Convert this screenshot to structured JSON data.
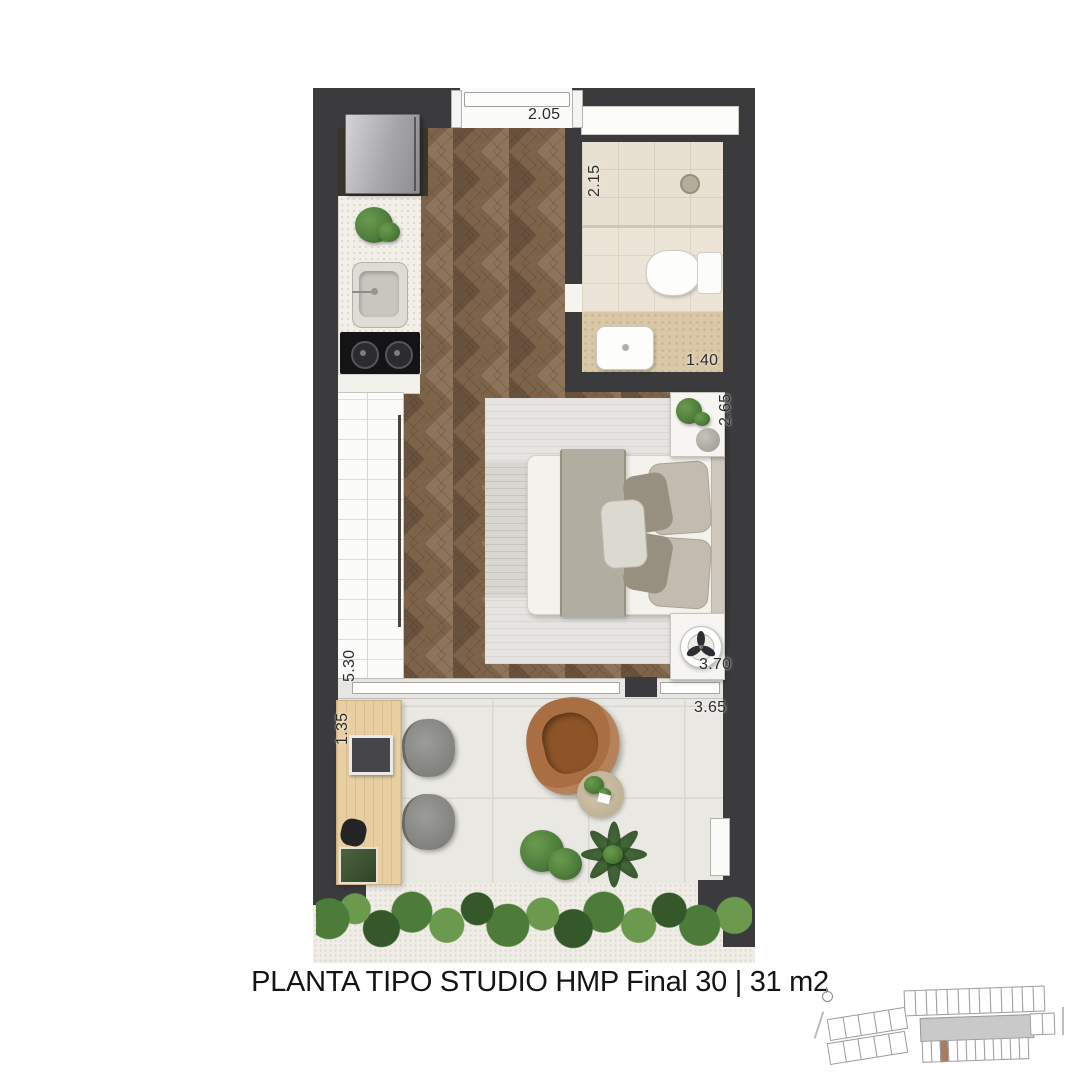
{
  "caption": "PLANTA TIPO STUDIO HMP Final 30 | 31 m2",
  "dims": {
    "entry": "2.05",
    "bath_width": "2.15",
    "bath_depth": "1.40",
    "bed_wall": "2.65",
    "wardrobe_wall": "5.30",
    "room_width": "3.70",
    "desk": "1.35",
    "balcony_width": "3.65"
  },
  "colors": {
    "wall": "#3b3a3c",
    "alcove": "#3a342e",
    "wood_mid": "#7d6349",
    "wood_light": "#8e745a",
    "wood_dark": "#69523d",
    "counter": "#f1efe8",
    "bath_floor": "#e8e1d2",
    "vanity_floor": "#d9c7a6",
    "balcony_floor": "#eae8e3",
    "rug": "#d8d7d2",
    "bed": "#f4f2ec",
    "blanket": "#b2ada1",
    "armchair": "#a96e41",
    "armchair_seat": "#8e5428",
    "desk_wood": "#e8cfa2",
    "green_light": "#6b9a4e",
    "green_mid": "#4d7c3a",
    "green_dark": "#35582a",
    "keyplan_highlight": "#a87c5f",
    "text": "#141414",
    "dim_text": "#2b2b2c"
  },
  "keyplan": {
    "top_row_units": 13,
    "left_top_units": 5,
    "left_bottom_units": 5,
    "bottom_row_units": 12,
    "right_units": 2,
    "highlight_index": 2
  }
}
